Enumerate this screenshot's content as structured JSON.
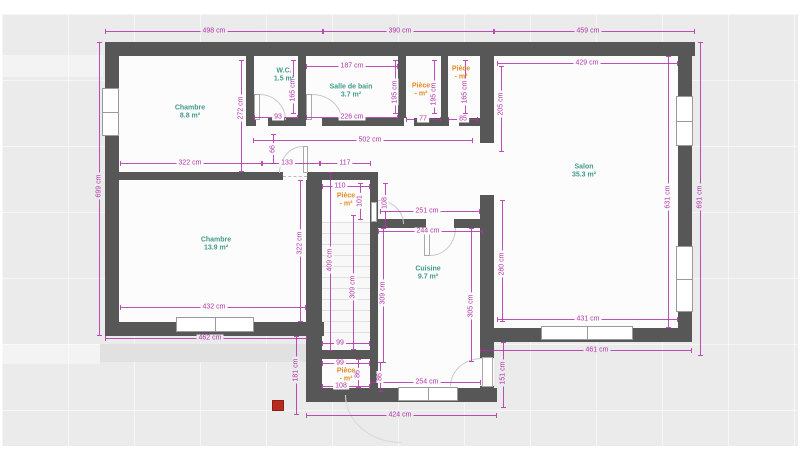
{
  "canvas": {
    "wall_color": "#575757",
    "dim_color": "#b232aa",
    "room_label_color": "#419b8c",
    "piece_label_color": "#e18c23",
    "marker_color": "#b92a1e",
    "unit": "cm"
  },
  "rooms": [
    {
      "name": "Chambre",
      "area": "8.8 m²",
      "color": "teal",
      "x": 190,
      "y": 113
    },
    {
      "name": "W.C.",
      "area": "1.5 m²",
      "color": "teal",
      "x": 284,
      "y": 76
    },
    {
      "name": "Salle de bain",
      "area": "3.7 m²",
      "color": "teal",
      "x": 351,
      "y": 92
    },
    {
      "name": "Pièce",
      "area": "- m²",
      "color": "orange",
      "x": 421,
      "y": 91
    },
    {
      "name": "Pièce",
      "area": "- m²",
      "color": "orange",
      "x": 461,
      "y": 74
    },
    {
      "name": "Salon",
      "area": "35.3 m²",
      "color": "teal",
      "x": 584,
      "y": 172
    },
    {
      "name": "Chambre",
      "area": "13.9 m²",
      "color": "teal",
      "x": 216,
      "y": 245
    },
    {
      "name": "Pièce",
      "area": "- m²",
      "color": "orange",
      "x": 346,
      "y": 201
    },
    {
      "name": "Cuisine",
      "area": "9.7 m²",
      "color": "teal",
      "x": 428,
      "y": 274
    },
    {
      "name": "Pièce",
      "area": "- m²",
      "color": "orange",
      "x": 346,
      "y": 376
    }
  ],
  "dims_h": [
    {
      "t": "498 cm",
      "y": 31,
      "x1": 105,
      "x2": 323,
      "lx": 214,
      "s": "g"
    },
    {
      "t": "390 cm",
      "y": 31,
      "x1": 323,
      "x2": 494,
      "lx": 400,
      "s": "g"
    },
    {
      "t": "459 cm",
      "y": 31,
      "x1": 494,
      "x2": 695,
      "lx": 588,
      "s": "g"
    },
    {
      "t": "187 cm",
      "y": 66,
      "x1": 306,
      "x2": 398,
      "lx": 352,
      "s": "w"
    },
    {
      "t": "429 cm",
      "y": 63,
      "x1": 497,
      "x2": 678,
      "lx": 587,
      "s": "w"
    },
    {
      "t": "93",
      "y": 117,
      "x1": 254,
      "x2": 298,
      "lx": 278,
      "s": "w"
    },
    {
      "t": "226 cm",
      "y": 117,
      "x1": 306,
      "x2": 398,
      "lx": 352,
      "s": "w"
    },
    {
      "t": "77",
      "y": 119,
      "x1": 406,
      "x2": 441,
      "lx": 423,
      "s": "w"
    },
    {
      "t": "85",
      "y": 119,
      "x1": 448,
      "x2": 478,
      "lx": 463,
      "s": "w"
    },
    {
      "t": "502 cm",
      "y": 140,
      "x1": 253,
      "x2": 473,
      "lx": 370,
      "s": "w"
    },
    {
      "t": "322 cm",
      "y": 163,
      "x1": 120,
      "x2": 262,
      "lx": 190,
      "s": "w"
    },
    {
      "t": "133",
      "y": 163,
      "x1": 262,
      "x2": 320,
      "lx": 287,
      "s": "w"
    },
    {
      "t": "117",
      "y": 163,
      "x1": 320,
      "x2": 371,
      "lx": 345,
      "s": "w"
    },
    {
      "t": "110",
      "y": 186,
      "x1": 322,
      "x2": 370,
      "lx": 340,
      "s": "w"
    },
    {
      "t": "251 cm",
      "y": 211,
      "x1": 380,
      "x2": 480,
      "lx": 427,
      "s": "w"
    },
    {
      "t": "244 cm",
      "y": 231,
      "x1": 378,
      "x2": 483,
      "lx": 428,
      "s": "w"
    },
    {
      "t": "432 cm",
      "y": 307,
      "x1": 120,
      "x2": 306,
      "lx": 214,
      "s": "w"
    },
    {
      "t": "462 cm",
      "y": 338,
      "x1": 105,
      "x2": 307,
      "lx": 210,
      "s": "g"
    },
    {
      "t": "431 cm",
      "y": 319,
      "x1": 497,
      "x2": 678,
      "lx": 588,
      "s": "w"
    },
    {
      "t": "461 cm",
      "y": 350,
      "x1": 480,
      "x2": 692,
      "lx": 597,
      "s": "g"
    },
    {
      "t": "99",
      "y": 343,
      "x1": 322,
      "x2": 370,
      "lx": 340,
      "s": "w"
    },
    {
      "t": "99",
      "y": 363,
      "x1": 322,
      "x2": 370,
      "lx": 340,
      "s": "w"
    },
    {
      "t": "108",
      "y": 386,
      "x1": 322,
      "x2": 370,
      "lx": 341,
      "s": "w"
    },
    {
      "t": "254 cm",
      "y": 382,
      "x1": 370,
      "x2": 481,
      "lx": 427,
      "s": "w"
    },
    {
      "t": "424 cm",
      "y": 415,
      "x1": 306,
      "x2": 497,
      "lx": 400,
      "s": "g"
    }
  ],
  "dims_v": [
    {
      "t": "699 cm",
      "x": 99,
      "y1": 42,
      "y2": 336,
      "ly": 186,
      "s": "g"
    },
    {
      "t": "272 cm",
      "x": 241,
      "y1": 60,
      "y2": 172,
      "ly": 108,
      "s": "w"
    },
    {
      "t": "165 cm",
      "x": 293,
      "y1": 60,
      "y2": 114,
      "ly": 90,
      "s": "w"
    },
    {
      "t": "195 cm",
      "x": 395,
      "y1": 60,
      "y2": 114,
      "ly": 92,
      "s": "w"
    },
    {
      "t": "195 cm",
      "x": 434,
      "y1": 60,
      "y2": 114,
      "ly": 94,
      "s": "w"
    },
    {
      "t": "165 cm",
      "x": 465,
      "y1": 60,
      "y2": 114,
      "ly": 92,
      "s": "w"
    },
    {
      "t": "205 cm",
      "x": 501,
      "y1": 66,
      "y2": 152,
      "ly": 104,
      "s": "w"
    },
    {
      "t": "66",
      "x": 273,
      "y1": 134,
      "y2": 164,
      "ly": 149,
      "s": "w"
    },
    {
      "t": "101",
      "x": 360,
      "y1": 183,
      "y2": 220,
      "ly": 201,
      "s": "w"
    },
    {
      "t": "108",
      "x": 385,
      "y1": 183,
      "y2": 227,
      "ly": 203,
      "s": "w"
    },
    {
      "t": "322 cm",
      "x": 300,
      "y1": 180,
      "y2": 322,
      "ly": 243,
      "s": "w"
    },
    {
      "t": "409 cm",
      "x": 330,
      "y1": 172,
      "y2": 351,
      "ly": 260,
      "s": "w"
    },
    {
      "t": "309 cm",
      "x": 353,
      "y1": 215,
      "y2": 350,
      "ly": 287,
      "s": "w"
    },
    {
      "t": "309 cm",
      "x": 383,
      "y1": 228,
      "y2": 363,
      "ly": 293,
      "s": "w"
    },
    {
      "t": "305 cm",
      "x": 471,
      "y1": 228,
      "y2": 362,
      "ly": 306,
      "s": "w"
    },
    {
      "t": "280 cm",
      "x": 502,
      "y1": 200,
      "y2": 322,
      "ly": 264,
      "s": "w"
    },
    {
      "t": "631 cm",
      "x": 668,
      "y1": 56,
      "y2": 328,
      "ly": 197,
      "s": "w"
    },
    {
      "t": "691 cm",
      "x": 700,
      "y1": 42,
      "y2": 356,
      "ly": 197,
      "s": "g"
    },
    {
      "t": "181 cm",
      "x": 296,
      "y1": 336,
      "y2": 415,
      "ly": 370,
      "s": "g"
    },
    {
      "t": "151 cm",
      "x": 503,
      "y1": 342,
      "y2": 408,
      "ly": 373,
      "s": "g"
    },
    {
      "t": "86",
      "x": 358,
      "y1": 359,
      "y2": 388,
      "ly": 374,
      "s": "w"
    },
    {
      "t": "86",
      "x": 380,
      "y1": 362,
      "y2": 392,
      "ly": 377,
      "s": "w"
    }
  ]
}
